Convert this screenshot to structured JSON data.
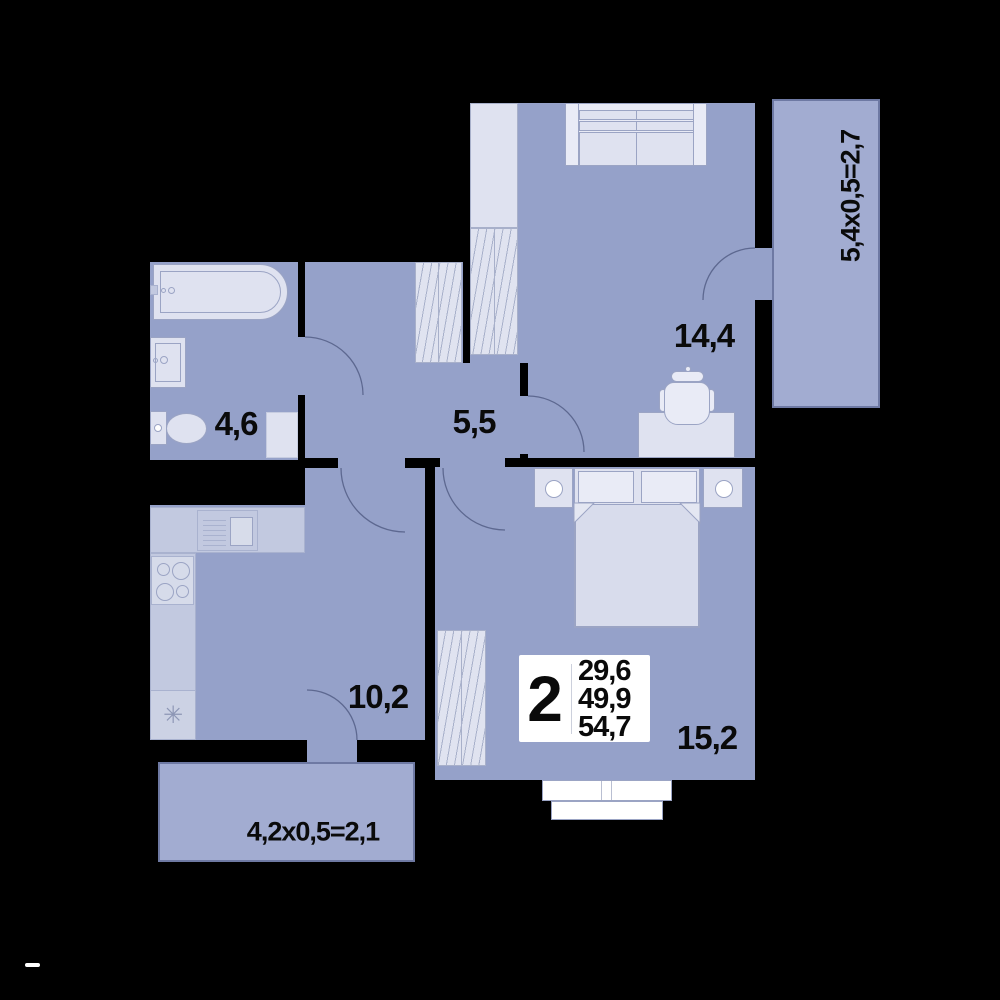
{
  "plan": {
    "title": "2-room apartment floor plan",
    "badge": {
      "rooms_count": "2",
      "area_line1": "29,6",
      "area_line2": "49,9",
      "area_line3": "54,7"
    },
    "rooms": [
      {
        "id": "living-room",
        "label": "14,4"
      },
      {
        "id": "hallway",
        "label": "5,5"
      },
      {
        "id": "bathroom",
        "label": "4,6"
      },
      {
        "id": "kitchen",
        "label": "10,2"
      },
      {
        "id": "bedroom",
        "label": "15,2"
      }
    ],
    "balconies": [
      {
        "id": "balcony-right",
        "label": "5,4x0,5=2,7"
      },
      {
        "id": "balcony-bottom",
        "label": "4,2x0,5=2,1"
      }
    ],
    "symbols": {
      "fridge": "✳"
    },
    "colors": {
      "background": "#000000",
      "room_fill": "#95a1c9",
      "balcony_fill": "#a2acd1",
      "furniture_fill": "#dfe2f0",
      "badge_bg": "#ffffff",
      "text": "#0a0a0a"
    }
  }
}
